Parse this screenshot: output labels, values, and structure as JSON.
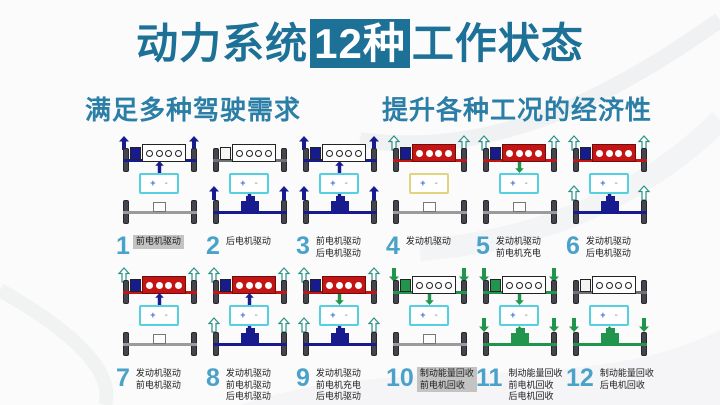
{
  "title": {
    "pre": "动力系统",
    "highlight": "12种",
    "post": "工作状态"
  },
  "subtitles": {
    "left": "满足多种驾驶需求",
    "right": "提升各种工况的经济性"
  },
  "battery": {
    "plus": "+",
    "minus": "-"
  },
  "colors": {
    "navy": "#181b8e",
    "red": "#c51414",
    "teal": "#2a8f84",
    "green": "#21954c",
    "gray_front": "#6f6f76",
    "gray_rear": "#9b9b9b",
    "cyan": "#55d0e0",
    "yellow": "#e4d37e",
    "number": "#4ba2c9",
    "title": "#1d7096",
    "label_bg": "#c3c3c3"
  },
  "diagrams": [
    {
      "num": "1",
      "labels": [
        "前电机驱动"
      ],
      "highlight": true,
      "engine": "white",
      "motor": "blue",
      "front_axle": "navy",
      "front_arrows": {
        "dir": "up",
        "color": "navy"
      },
      "battery": "cyan",
      "batt_front": {
        "dir": "up",
        "color": "navy"
      },
      "batt_rear": null,
      "rear": "idle",
      "rear_arrows": null
    },
    {
      "num": "2",
      "labels": [
        "后电机驱动"
      ],
      "highlight": false,
      "engine": "white",
      "motor": "gray",
      "front_axle": "gray",
      "front_arrows": null,
      "battery": "cyan",
      "batt_front": null,
      "batt_rear": {
        "dir": "down",
        "color": "navy"
      },
      "rear": "navy",
      "rear_arrows": {
        "dir": "up",
        "color": "navy"
      }
    },
    {
      "num": "3",
      "labels": [
        "前电机驱动",
        "后电机驱动"
      ],
      "highlight": false,
      "engine": "white",
      "motor": "blue",
      "front_axle": "navy",
      "front_arrows": {
        "dir": "up",
        "color": "navy"
      },
      "battery": "cyan",
      "batt_front": {
        "dir": "up",
        "color": "navy"
      },
      "batt_rear": {
        "dir": "down",
        "color": "navy"
      },
      "rear": "navy",
      "rear_arrows": {
        "dir": "up",
        "color": "navy"
      }
    },
    {
      "num": "4",
      "labels": [
        "发动机驱动"
      ],
      "highlight": false,
      "engine": "red",
      "motor": "blue",
      "front_axle": "red",
      "front_arrows": {
        "dir": "up",
        "color": "teal"
      },
      "battery": "yellow",
      "batt_front": null,
      "batt_rear": null,
      "rear": "idle",
      "rear_arrows": null
    },
    {
      "num": "5",
      "labels": [
        "发动机驱动",
        "前电机充电"
      ],
      "highlight": false,
      "engine": "red",
      "motor": "blue",
      "front_axle": "red",
      "front_arrows": {
        "dir": "up",
        "color": "teal"
      },
      "battery": "cyan",
      "batt_front": {
        "dir": "down",
        "color": "green"
      },
      "batt_rear": null,
      "rear": "idle",
      "rear_arrows": null
    },
    {
      "num": "6",
      "labels": [
        "发动机驱动",
        "后电机驱动"
      ],
      "highlight": false,
      "engine": "red",
      "motor": "blue",
      "front_axle": "red",
      "front_arrows": {
        "dir": "up",
        "color": "teal"
      },
      "battery": "cyan",
      "batt_front": null,
      "batt_rear": {
        "dir": "down",
        "color": "navy"
      },
      "rear": "navy",
      "rear_arrows": {
        "dir": "up",
        "color": "teal"
      }
    },
    {
      "num": "7",
      "labels": [
        "发动机驱动",
        "前电机驱动"
      ],
      "highlight": false,
      "engine": "red",
      "motor": "blue",
      "front_axle": "red",
      "front_arrows": {
        "dir": "up",
        "color": "teal"
      },
      "battery": "cyan",
      "batt_front": {
        "dir": "up",
        "color": "navy"
      },
      "batt_rear": null,
      "rear": "idle",
      "rear_arrows": null
    },
    {
      "num": "8",
      "labels": [
        "发动机驱动",
        "前电机驱动",
        "后电机驱动"
      ],
      "highlight": false,
      "engine": "red",
      "motor": "blue",
      "front_axle": "red",
      "front_arrows": {
        "dir": "up",
        "color": "teal"
      },
      "battery": "cyan",
      "batt_front": {
        "dir": "up",
        "color": "navy"
      },
      "batt_rear": {
        "dir": "down",
        "color": "navy"
      },
      "rear": "navy",
      "rear_arrows": {
        "dir": "up",
        "color": "teal"
      }
    },
    {
      "num": "9",
      "labels": [
        "发动机驱动",
        "前电机充电",
        "后电机驱动"
      ],
      "highlight": false,
      "engine": "red",
      "motor": "blue",
      "front_axle": "red",
      "front_arrows": {
        "dir": "up",
        "color": "teal"
      },
      "battery": "cyan",
      "batt_front": {
        "dir": "down",
        "color": "green"
      },
      "batt_rear": {
        "dir": "down",
        "color": "navy"
      },
      "rear": "navy",
      "rear_arrows": {
        "dir": "up",
        "color": "teal"
      }
    },
    {
      "num": "10",
      "labels": [
        "制动能量回收",
        "前电机回收"
      ],
      "highlight": true,
      "engine": "white",
      "motor": "green",
      "front_axle": "green",
      "front_arrows": {
        "dir": "down",
        "color": "green"
      },
      "battery": "cyan",
      "batt_front": {
        "dir": "down",
        "color": "green"
      },
      "batt_rear": null,
      "rear": "idle",
      "rear_arrows": null
    },
    {
      "num": "11",
      "labels": [
        "制动能量回收",
        "前电机回收",
        "后电机回收"
      ],
      "highlight": false,
      "engine": "white",
      "motor": "green",
      "front_axle": "green",
      "front_arrows": {
        "dir": "down",
        "color": "green"
      },
      "battery": "cyan",
      "batt_front": {
        "dir": "down",
        "color": "green"
      },
      "batt_rear": {
        "dir": "up",
        "color": "green"
      },
      "rear": "green",
      "rear_arrows": {
        "dir": "down",
        "color": "green"
      }
    },
    {
      "num": "12",
      "labels": [
        "制动能量回收",
        "后电机回收"
      ],
      "highlight": false,
      "engine": "white",
      "motor": "gray",
      "front_axle": "gray",
      "front_arrows": null,
      "battery": "cyan",
      "batt_front": null,
      "batt_rear": {
        "dir": "up",
        "color": "green"
      },
      "rear": "green",
      "rear_arrows": {
        "dir": "down",
        "color": "green"
      }
    }
  ]
}
